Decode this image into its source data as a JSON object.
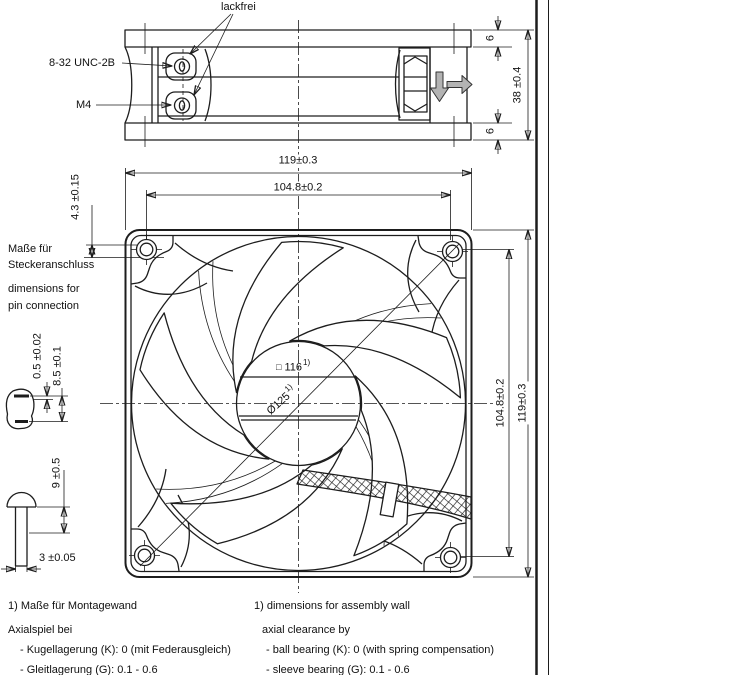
{
  "side_view": {
    "lackfrei_label": "lackfrei",
    "screw_thread_top": "8-32 UNC-2B",
    "screw_thread_bottom": "M4",
    "depth_dim": "38 ±0.4",
    "flange_top_dim": "6",
    "flange_bottom_dim": "6"
  },
  "front_view": {
    "width_dim": "119±0.3",
    "hole_pitch_dim": "104.8±0.2",
    "pin_depth_dim": "4.3 ±0.15",
    "height_hole_pitch_dim": "104.8±0.2",
    "height_dim": "119±0.3",
    "hub_square_symbol": "□",
    "hub_square_dim": "116",
    "blade_circle_dim": "Ø125",
    "footnote_ref": "1)"
  },
  "pin_connection_note": {
    "de_line1": "Maße für",
    "de_line2": "Steckeranschluss",
    "en_line1": "dimensions for",
    "en_line2": "pin connection"
  },
  "detail_dims": {
    "pin_protrusion": "0.5 ±0.02",
    "pin_spacing": "8.5 ±0.1",
    "rivet_length": "9 ±0.5",
    "rivet_diameter": "3 ±0.05"
  },
  "footnotes": {
    "de": [
      "1) Maße für Montagewand",
      "Axialspiel bei",
      "- Kugellagerung (K): 0 (mit Federausgleich)",
      "- Gleitlagerung (G): 0.1 - 0.6"
    ],
    "en": [
      "1) dimensions for assembly wall",
      "axial clearance by",
      "- ball bearing (K): 0 (with spring compensation)",
      "- sleeve bearing (G): 0.1 - 0.6"
    ]
  },
  "colors": {
    "line": "#1d1d1d",
    "airflow_arrow_fill": "#b3b3b3",
    "background": "#ffffff"
  }
}
